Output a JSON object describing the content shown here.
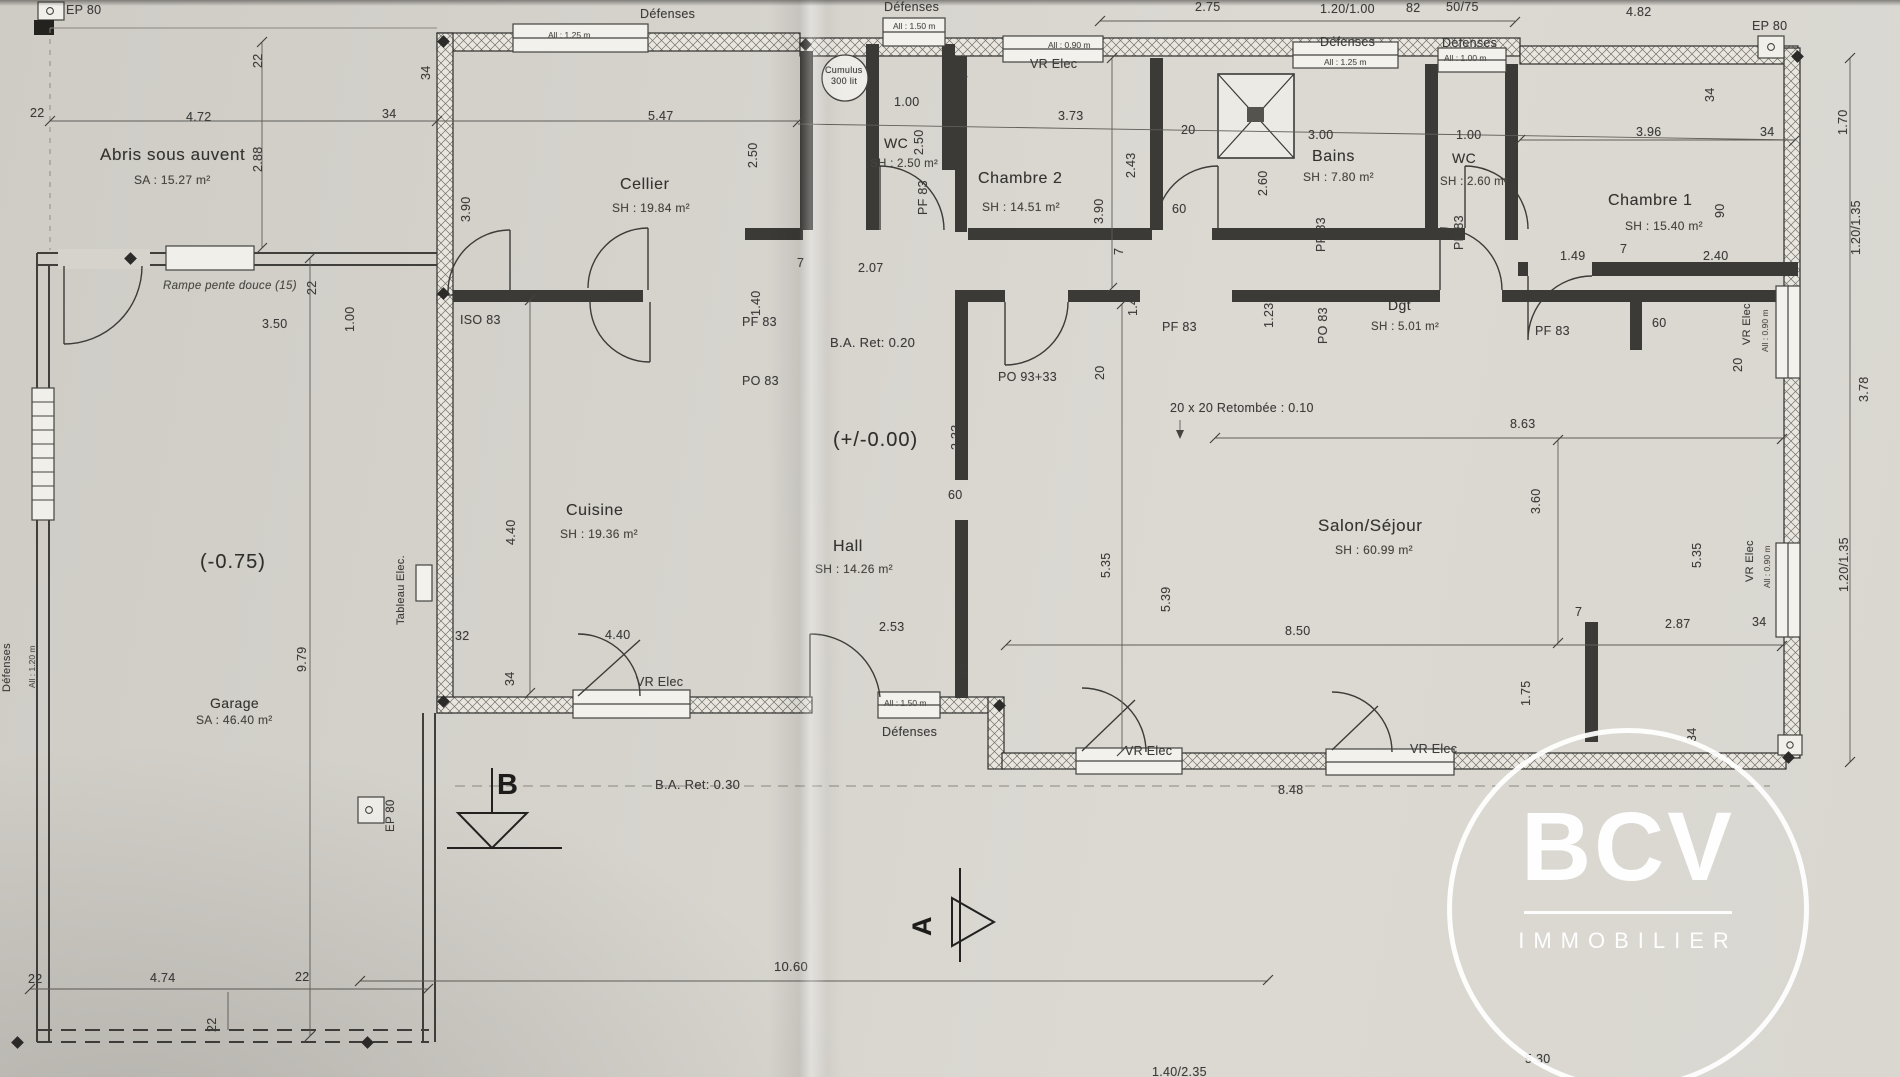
{
  "logo": {
    "name": "BCV",
    "sub": "IMMOBILIER"
  },
  "rooms": {
    "abris": {
      "name": "Abris sous auvent",
      "area": "SA : 15.27 m²"
    },
    "cellier": {
      "name": "Cellier",
      "area": "SH : 19.84 m²"
    },
    "wc1": {
      "name": "WC",
      "area": "SH : 2.50 m²"
    },
    "chambre2": {
      "name": "Chambre 2",
      "area": "SH : 14.51 m²"
    },
    "bains": {
      "name": "Bains",
      "area": "SH : 7.80 m²"
    },
    "wc2": {
      "name": "WC",
      "area": "SH : 2.60 m²"
    },
    "chambre1": {
      "name": "Chambre 1",
      "area": "SH : 15.40 m²"
    },
    "dgt": {
      "name": "Dgt",
      "area": "SH : 5.01 m²"
    },
    "cuisine": {
      "name": "Cuisine",
      "area": "SH : 19.36 m²"
    },
    "hall": {
      "name": "Hall",
      "area": "SH : 14.26 m²"
    },
    "salon": {
      "name": "Salon/Séjour",
      "area": "SH : 60.99 m²"
    },
    "garage": {
      "name": "Garage",
      "area": "SA : 46.40 m²"
    }
  },
  "levels": {
    "garage": "(-0.75)",
    "rdc": "(+/-0.00)"
  },
  "notes": {
    "ba20": "B.A. Ret: 0.20",
    "ba30": "B.A. Ret: 0.30",
    "retombee": "20 x 20 Retombée : 0.10",
    "rampe": "Rampe pente douce (15)",
    "cumulus1": "Cumulus",
    "cumulus2": "300 lit",
    "tableau": "Tableau Elec."
  },
  "labels": {
    "ep80": "EP 80",
    "defenses": "Défenses",
    "vrelec": "VR Elec"
  },
  "openings": {
    "pf83": "PF 83",
    "po83": "PO 83",
    "iso83": "ISO 83",
    "po9333": "PO 93+33"
  },
  "allow": {
    "a125": "All : 1.25 m",
    "a150": "All : 1.50 m",
    "a090": "All : 0.90 m",
    "a120": "All : 1.20 m",
    "a100": "All : 1.00 m"
  },
  "markers": {
    "a": "A",
    "b": "B"
  },
  "dims": {
    "v7": "7",
    "v20": "20",
    "v22": "22",
    "v32": "32",
    "v34": "34",
    "v60": "60",
    "v82": "82",
    "v90": "90",
    "v100": "1.00",
    "v123": "1.23",
    "v140": "1.40",
    "v149": "1.49",
    "v170": "1.70",
    "v175": "1.75",
    "v200": "2.00",
    "v207": "2.07",
    "v233": "2.33",
    "v240": "2.40",
    "v243": "2.43",
    "v250": "2.50",
    "v253": "2.53",
    "v260": "2.60",
    "v275": "2.75",
    "v287": "2.87",
    "v288": "2.88",
    "v300": "3.00",
    "v350": "3.50",
    "v360": "3.60",
    "v373": "3.73",
    "v378": "3.78",
    "v390": "3.90",
    "v396": "3.96",
    "v440": "4.40",
    "v472": "4.72",
    "v474": "4.74",
    "v482": "4.82",
    "v530": "5.30",
    "v535": "5.35",
    "v539": "5.39",
    "v547": "5.47",
    "v848": "8.48",
    "v850": "8.50",
    "v863": "8.63",
    "v979": "9.79",
    "v1060": "10.60",
    "v120100": "1.20/1.00",
    "v120135": "1.20/1.35",
    "v140235": "1.40/2.35",
    "v5075": "50/75"
  }
}
